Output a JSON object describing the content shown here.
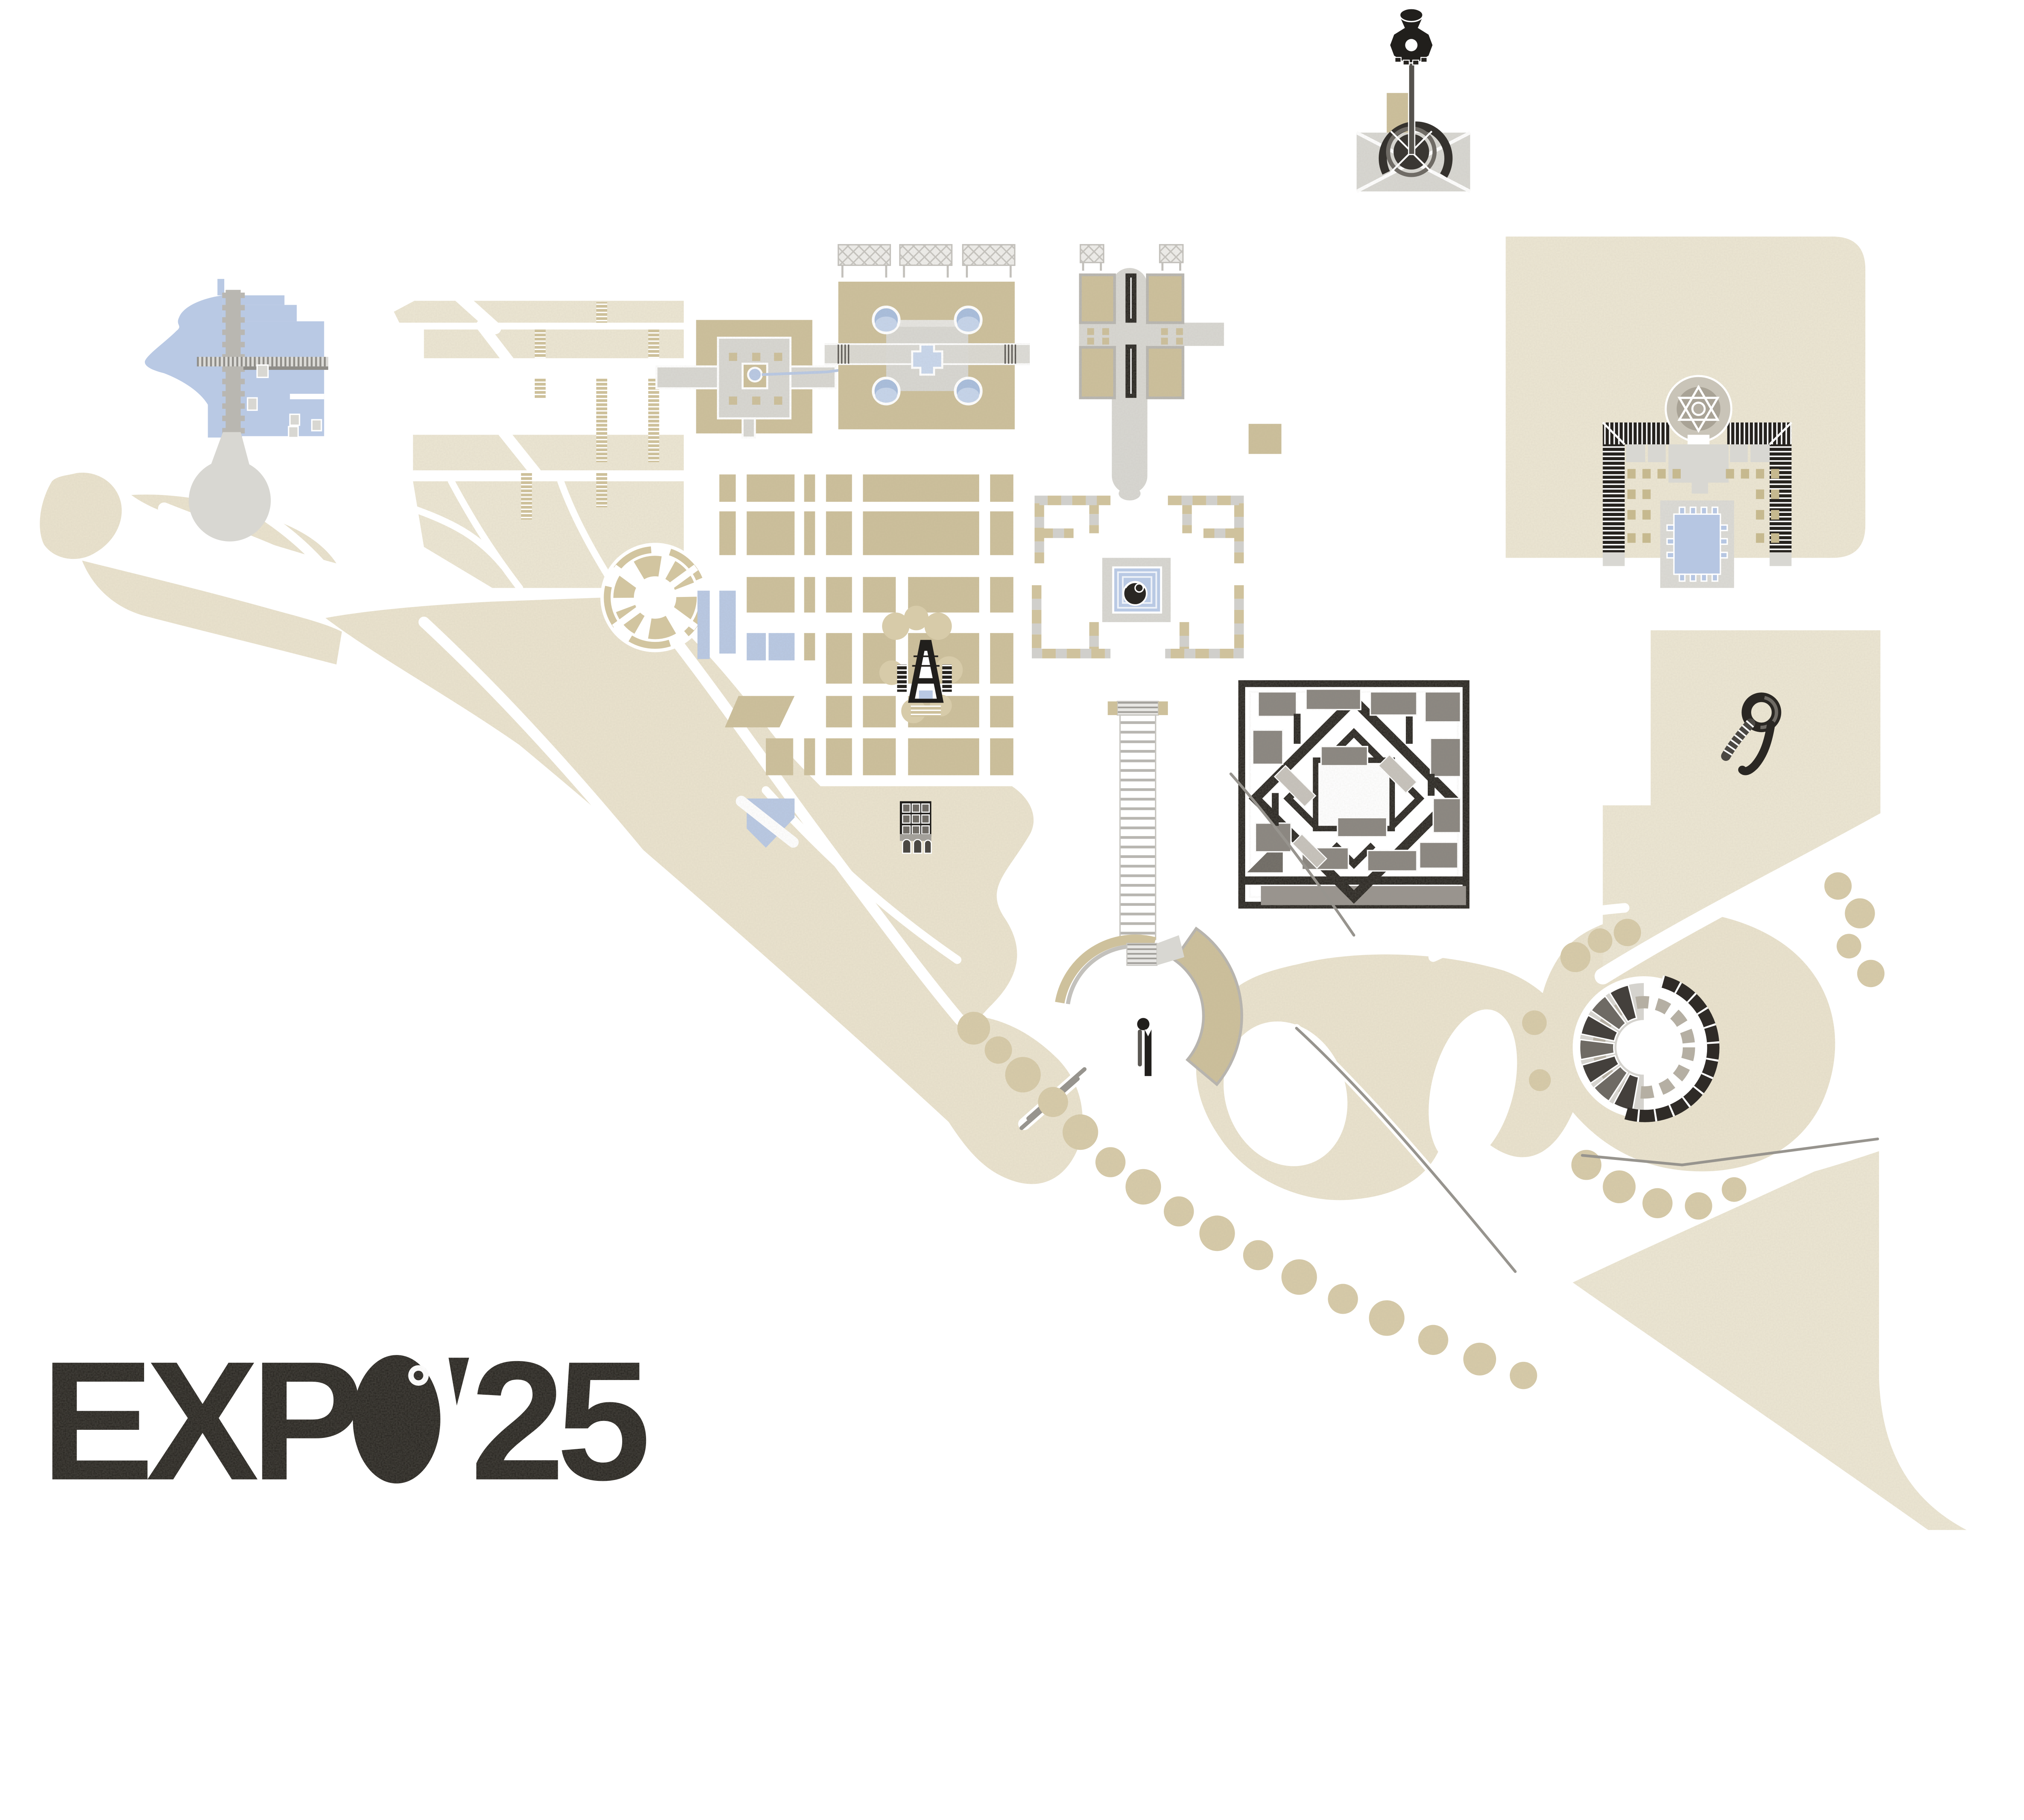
{
  "logo": {
    "title": "EXPO'25",
    "prefix": "EXP",
    "o_letter": "O",
    "apostrophe": "'",
    "suffix": "25"
  },
  "palette": {
    "background": "#ffffff",
    "terrain": "#eae3ce",
    "terrain_light": "#ece6d3",
    "parterre_beige": "#cdc09b",
    "tree_canopy": "#d7cba9",
    "water": "#b9c9e4",
    "water_light": "#c9d7ec",
    "paving_light": "#d8d7d2",
    "paving_dark": "#b9b7b1",
    "ink_black": "#211f1c",
    "steel_gray": "#8f8d88"
  }
}
